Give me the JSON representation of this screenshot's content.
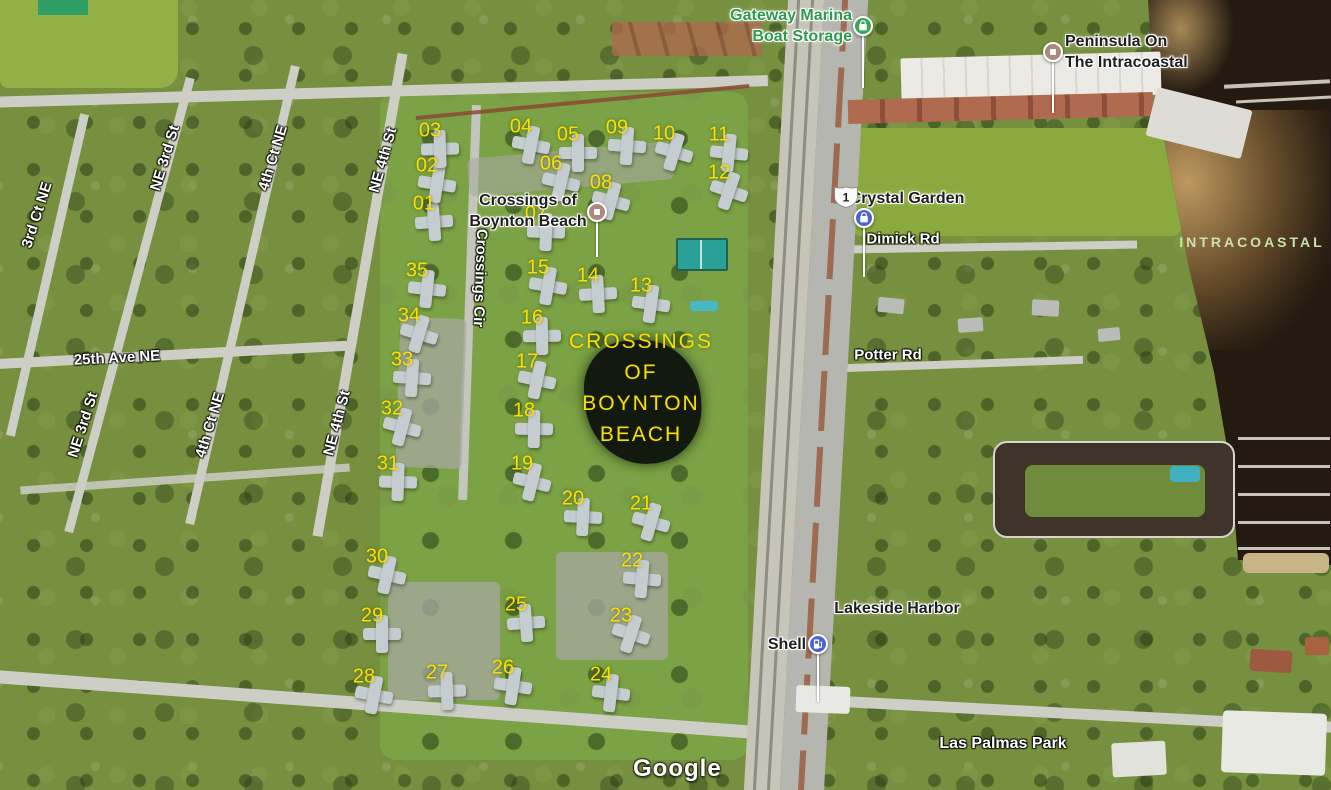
{
  "map": {
    "watermark": {
      "text": "Google"
    },
    "colors": {
      "unit_number_yellow": "#f9e000",
      "area_label_yellow": "#f9e000",
      "road_label_white": "#ffffff",
      "place_label_dark": "#1f1f1f",
      "poi_green": "#2f9a4e",
      "water_label_green": "#cfeab3",
      "marker_brown": "#a98a7c",
      "marker_blue": "#4a64d1",
      "marker_green": "#3aa757"
    },
    "unit_numbers": [
      {
        "n": "01",
        "x": 424,
        "y": 204
      },
      {
        "n": "02",
        "x": 427,
        "y": 166
      },
      {
        "n": "03",
        "x": 430,
        "y": 131
      },
      {
        "n": "04",
        "x": 521,
        "y": 127
      },
      {
        "n": "05",
        "x": 568,
        "y": 135
      },
      {
        "n": "06",
        "x": 551,
        "y": 164
      },
      {
        "n": "07",
        "x": 536,
        "y": 214
      },
      {
        "n": "08",
        "x": 601,
        "y": 183
      },
      {
        "n": "09",
        "x": 617,
        "y": 128
      },
      {
        "n": "10",
        "x": 664,
        "y": 134
      },
      {
        "n": "11",
        "x": 719,
        "y": 135
      },
      {
        "n": "12",
        "x": 719,
        "y": 173
      },
      {
        "n": "13",
        "x": 641,
        "y": 286
      },
      {
        "n": "14",
        "x": 588,
        "y": 276
      },
      {
        "n": "15",
        "x": 538,
        "y": 268
      },
      {
        "n": "16",
        "x": 532,
        "y": 318
      },
      {
        "n": "17",
        "x": 527,
        "y": 362
      },
      {
        "n": "18",
        "x": 524,
        "y": 411
      },
      {
        "n": "19",
        "x": 522,
        "y": 464
      },
      {
        "n": "20",
        "x": 573,
        "y": 499
      },
      {
        "n": "21",
        "x": 641,
        "y": 504
      },
      {
        "n": "22",
        "x": 632,
        "y": 561
      },
      {
        "n": "23",
        "x": 621,
        "y": 616
      },
      {
        "n": "24",
        "x": 601,
        "y": 675
      },
      {
        "n": "25",
        "x": 516,
        "y": 605
      },
      {
        "n": "26",
        "x": 503,
        "y": 668
      },
      {
        "n": "27",
        "x": 437,
        "y": 673
      },
      {
        "n": "28",
        "x": 364,
        "y": 677
      },
      {
        "n": "29",
        "x": 372,
        "y": 616
      },
      {
        "n": "30",
        "x": 377,
        "y": 557
      },
      {
        "n": "31",
        "x": 388,
        "y": 464
      },
      {
        "n": "32",
        "x": 392,
        "y": 409
      },
      {
        "n": "33",
        "x": 402,
        "y": 360
      },
      {
        "n": "34",
        "x": 409,
        "y": 316
      },
      {
        "n": "35",
        "x": 417,
        "y": 271
      }
    ],
    "area_label": {
      "lines": [
        "CROSSINGS",
        "OF",
        "BOYNTON",
        "BEACH"
      ],
      "x": 641,
      "y": 326
    },
    "road_labels": [
      {
        "name": "road-label-3rd-ct-ne",
        "text": "3rd Ct NE",
        "x": 37,
        "y": 215,
        "rot": -72
      },
      {
        "name": "road-label-ne-3rd-st",
        "text": "NE 3rd St",
        "x": 165,
        "y": 158,
        "rot": -73
      },
      {
        "name": "road-label-4th-ct-ne",
        "text": "4th Ct NE",
        "x": 273,
        "y": 158,
        "rot": -73
      },
      {
        "name": "road-label-ne-4th-st",
        "text": "NE 4th St",
        "x": 383,
        "y": 160,
        "rot": -74
      },
      {
        "name": "road-label-ne-3rd-st-2",
        "text": "NE 3rd St",
        "x": 83,
        "y": 425,
        "rot": -72
      },
      {
        "name": "road-label-4th-ct-ne-2",
        "text": "4th Ct NE",
        "x": 210,
        "y": 425,
        "rot": -73
      },
      {
        "name": "road-label-ne-4th-st-2",
        "text": "NE 4th St",
        "x": 337,
        "y": 423,
        "rot": -75
      },
      {
        "name": "road-label-25th-ave-ne",
        "text": "25th Ave NE",
        "x": 117,
        "y": 358,
        "rot": -3
      },
      {
        "name": "road-label-crossings-cir",
        "text": "Crossings Cir",
        "x": 480,
        "y": 278,
        "rot": 92
      },
      {
        "name": "road-label-dimick-rd",
        "text": "Dimick Rd",
        "x": 903,
        "y": 239,
        "rot": 0
      },
      {
        "name": "road-label-potter-rd",
        "text": "Potter Rd",
        "x": 888,
        "y": 355,
        "rot": 0
      }
    ],
    "place_labels": [
      {
        "name": "gateway-marina-boat-storage-label",
        "lines": [
          "Gateway Marina",
          "Boat Storage"
        ],
        "x": 852,
        "y": 5,
        "align": "right",
        "style": "green"
      },
      {
        "name": "peninsula-on-the-intracoastal-label",
        "lines": [
          "Peninsula On",
          "The Intracoastal"
        ],
        "x": 1065,
        "y": 31,
        "align": "left",
        "style": "dark"
      },
      {
        "name": "crossings-of-boynton-beach-label",
        "lines": [
          "Crossings of",
          "Boynton Beach"
        ],
        "x": 528,
        "y": 190,
        "align": "center",
        "style": "dark"
      },
      {
        "name": "crystal-garden-label",
        "lines": [
          "Crystal Garden"
        ],
        "x": 907,
        "y": 188,
        "align": "center",
        "style": "dark"
      },
      {
        "name": "lakeside-harbor-label",
        "lines": [
          "Lakeside Harbor"
        ],
        "x": 897,
        "y": 598,
        "align": "center",
        "style": "dark"
      },
      {
        "name": "shell-label",
        "lines": [
          "Shell"
        ],
        "x": 787,
        "y": 634,
        "align": "center",
        "style": "dark"
      },
      {
        "name": "las-palmas-park-label",
        "lines": [
          "Las Palmas Park"
        ],
        "x": 1003,
        "y": 733,
        "align": "center",
        "style": "white"
      }
    ],
    "poi_markers": [
      {
        "name": "gateway-marina-boat-storage-marker",
        "glyph": "bag",
        "color_key": "marker_green",
        "x": 863,
        "y": 26,
        "stem_to": 88
      },
      {
        "name": "peninsula-on-the-intracoastal-marker",
        "glyph": "square",
        "color_key": "marker_brown",
        "x": 1053,
        "y": 52,
        "stem_to": 113
      },
      {
        "name": "crossings-of-boynton-beach-marker",
        "glyph": "square",
        "color_key": "marker_brown",
        "x": 597,
        "y": 212,
        "stem_to": 257
      },
      {
        "name": "crystal-garden-marker",
        "glyph": "bag",
        "color_key": "marker_blue",
        "x": 864,
        "y": 218,
        "stem_to": 277
      },
      {
        "name": "shell-marker",
        "glyph": "fuel",
        "color_key": "marker_blue",
        "x": 818,
        "y": 644,
        "stem_to": 702
      }
    ],
    "route_shield": {
      "text": "1",
      "x": 833,
      "y": 185
    },
    "water_label": {
      "text": "INTRACOASTAL",
      "x": 1252,
      "y": 242
    }
  }
}
